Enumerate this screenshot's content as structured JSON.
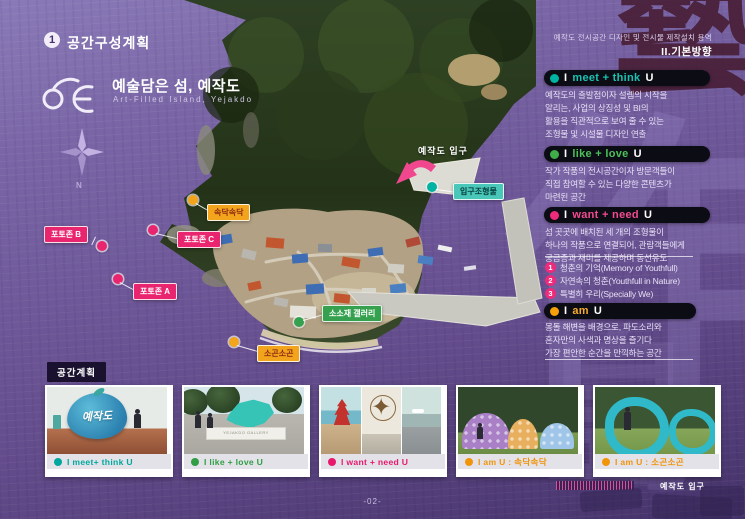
{
  "header": {
    "badge": "1",
    "title": "공간구성계획",
    "project": "예작도 전시공간 디자인 및 전시물 제작설치 용역",
    "section": "II.기본방향"
  },
  "logo": {
    "name_ko": "예술담은 섬, 예작도",
    "name_en": "Art-Filled Island, Yejakdo"
  },
  "compass": {
    "north": "N"
  },
  "map": {
    "entrance_text": "예작도 입구",
    "labels": [
      {
        "id": "entrance-sculpture",
        "text": "입구조형물",
        "color": "#49c7b8"
      },
      {
        "id": "sokdak-sokdak",
        "text": "속닥속닥",
        "color": "#f2a51c"
      },
      {
        "id": "photozone-b",
        "text": "포토존 B",
        "color": "#e8256e"
      },
      {
        "id": "photozone-c",
        "text": "포토존 C",
        "color": "#e8256e"
      },
      {
        "id": "photozone-a",
        "text": "포토존 A",
        "color": "#e8256e"
      },
      {
        "id": "sosojae-gallery",
        "text": "소소재 갤러리",
        "color": "#35a14f"
      },
      {
        "id": "sogon-sogon",
        "text": "소곤소곤",
        "color": "#f2a51c"
      }
    ]
  },
  "sections": [
    {
      "title_pre": "I",
      "title_mid": "meet + think",
      "title_post": "U",
      "color": "#00b2a2",
      "body": "예작도의 출발점이자 설렘의 시작을\n알리는, 사업의 상징성 및 BI의\n활용을 직관적으로 보여 줄 수 있는\n조형물 및 시설물 디자인 연출"
    },
    {
      "title_pre": "I",
      "title_mid": "like + love",
      "title_post": "U",
      "color": "#3fae49",
      "body": "작가 작품의 전시공간이자 방문객들이\n직접 참여할 수 있는 다양한 콘텐츠가\n마련된 공간"
    },
    {
      "title_pre": "I",
      "title_mid": "want + need",
      "title_post": "U",
      "color": "#ee2a7b",
      "body": "섬 곳곳에 배치된 세 개의 조형물이\n하나의 작품으로 연결되어, 관람객들에게\n궁금증과 재미를 제공하며 동선유도",
      "items": [
        {
          "num": "1",
          "text": "청춘의 기억(Memory of Youthfull)"
        },
        {
          "num": "2",
          "text": "자연속의 청춘(Youthfull in Nature)"
        },
        {
          "num": "3",
          "text": "특별히 우리(Specially We)"
        }
      ]
    },
    {
      "title_pre": "I",
      "title_mid": "am",
      "title_post": "U",
      "color": "#f5a10a",
      "body": "몽돌 해변을 배경으로, 파도소리와\n혼자만의 사색과 명상을 즐기다\n가장 편안한 순간을 만끽하는 공간"
    }
  ],
  "plan": {
    "label": "공간계획"
  },
  "thumbnails": [
    {
      "caption": "I meet+ think U",
      "color": "#00a79d",
      "sign_text": "예작도"
    },
    {
      "caption": "I like + love U",
      "color": "#2f9e44",
      "sign_text": "YEJAKDO GALLERY"
    },
    {
      "caption": "I want + need U",
      "color": "#e8186d"
    },
    {
      "caption": "I am U : 속닥속닥",
      "color": "#f0940a"
    },
    {
      "caption": "I am U : 소곤소곤",
      "color": "#f0940a"
    }
  ],
  "footer": {
    "page_number": "-02-",
    "right_label": "예작도 입구"
  },
  "decor": {
    "watermark_top": "藝",
    "watermark_mid": "作",
    "watermark_low": "島"
  }
}
